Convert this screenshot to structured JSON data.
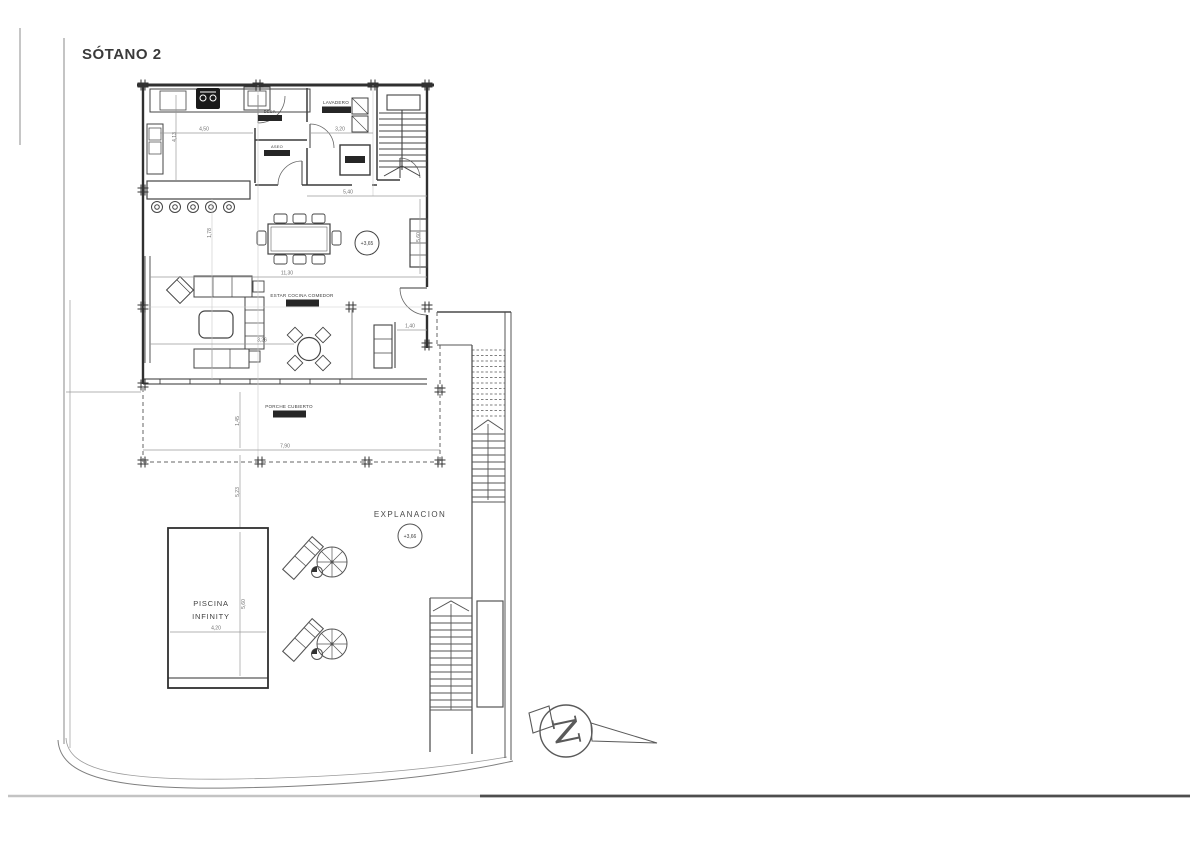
{
  "title": "SÓTANO 2",
  "plan": {
    "rooms": {
      "lavadero": "LAVADERO",
      "despensa": "DESP.",
      "aseo": "ASEO",
      "estar": "ESTAR COCINA COMEDOR",
      "porche": "PORCHE CUBIERTO",
      "explanacion": "EXPLANACION",
      "piscina_line1": "PISCINA",
      "piscina_line2": "INFINITY"
    },
    "levels": {
      "estar_level": "+3,65",
      "explanacion_level": "+3,66"
    },
    "compass_letter": "N",
    "dimensions": {
      "kitchen_width": "4,50",
      "lavadero_width": "3,20",
      "kitchen_depth": "4,13",
      "island_offset": "1,78",
      "living_width": "11,30",
      "corridor_width": "5,40",
      "living_depth": "5,60",
      "sofa_zone_width": "3,26",
      "door_offset": "1,40",
      "porch_width": "7,90",
      "porch_depth": "1,45",
      "terrace_depth": "5,23",
      "pool_length": "5,60",
      "pool_width": "4,20"
    },
    "colors": {
      "ink": "#333333",
      "dim_line": "#9a9a9a",
      "badge": "#262626"
    }
  }
}
